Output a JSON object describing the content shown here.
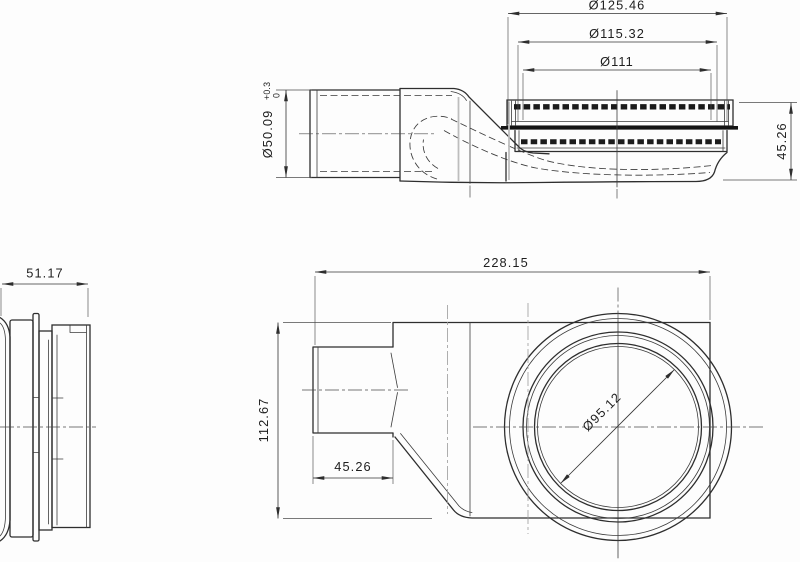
{
  "drawing": {
    "type": "technical-drawing",
    "background": "#fdfdfd",
    "line_color": "#2e2e2e",
    "side_view": {
      "dim_outer_dia": "Ø125.46",
      "dim_ring_dia": "Ø115.32",
      "dim_grate_dia": "Ø111",
      "dim_inlet_dia": "Ø50.09",
      "dim_inlet_dia_tol_upper": "+0.3",
      "dim_inlet_dia_tol_lower": "0",
      "dim_height": "45.26"
    },
    "flange_view": {
      "dim_width": "51.17"
    },
    "plan_view": {
      "dim_length": "228.15",
      "dim_height": "112.67",
      "dim_inlet_length": "45.26",
      "dim_bore_dia": "Ø95.12"
    }
  }
}
